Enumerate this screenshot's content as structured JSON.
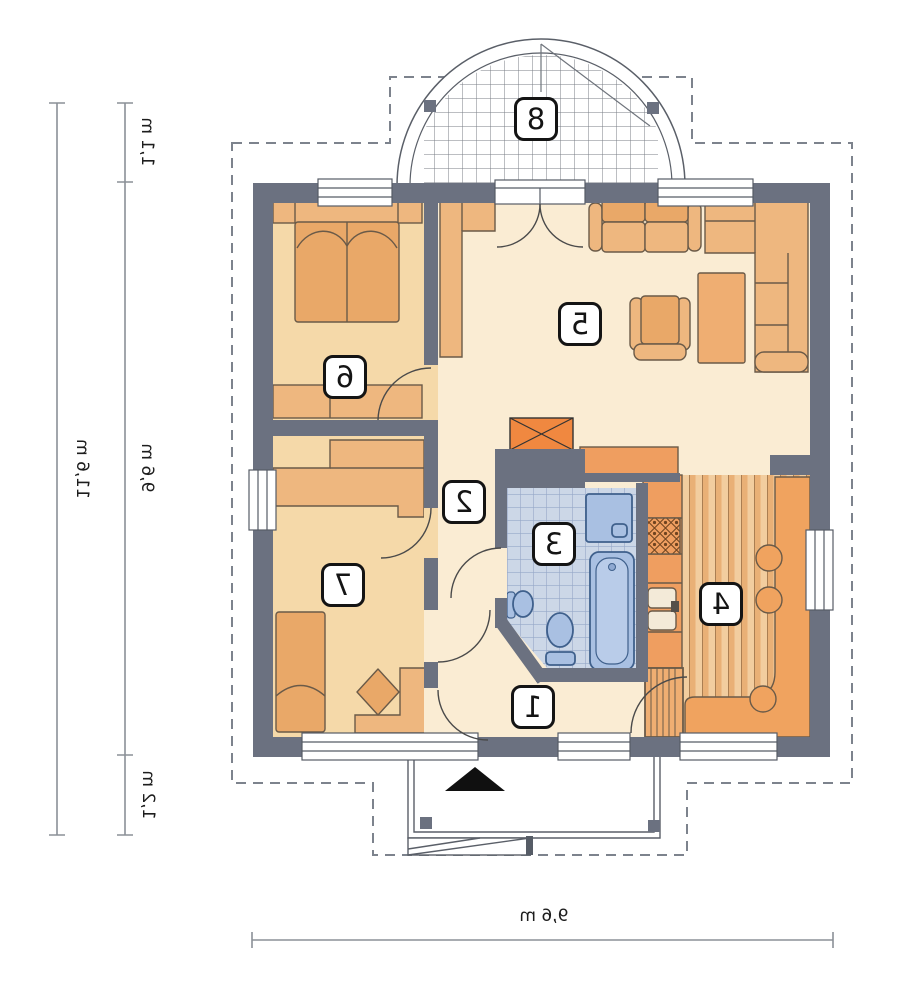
{
  "title": "Single-storey house floor plan (mirrored print)",
  "rooms": {
    "r1": {
      "number": "1"
    },
    "r2": {
      "number": "2"
    },
    "r3": {
      "number": "3"
    },
    "r4": {
      "number": "4"
    },
    "r5": {
      "number": "5"
    },
    "r6": {
      "number": "6"
    },
    "r7": {
      "number": "7"
    },
    "r8": {
      "number": "8"
    }
  },
  "dimensions": {
    "left_total": "11,6 m",
    "left_top": "1,1 m",
    "left_middle": "9,6 m",
    "left_bottom": "1,2 m",
    "bottom_width": "9,6 m"
  },
  "colors": {
    "wall": "#6b7180",
    "floor_cream": "#faecd3",
    "floor_peach": "#f5d9a9",
    "furniture_light": "#eeb77f",
    "furniture_mid": "#e9a868",
    "kitchen_counter": "#ef9e60",
    "fireplace": "#f08840",
    "bath_tile": "#ccd7e7",
    "bath_fixture": "#a9c0e2",
    "dash_outline": "#7d838d"
  }
}
